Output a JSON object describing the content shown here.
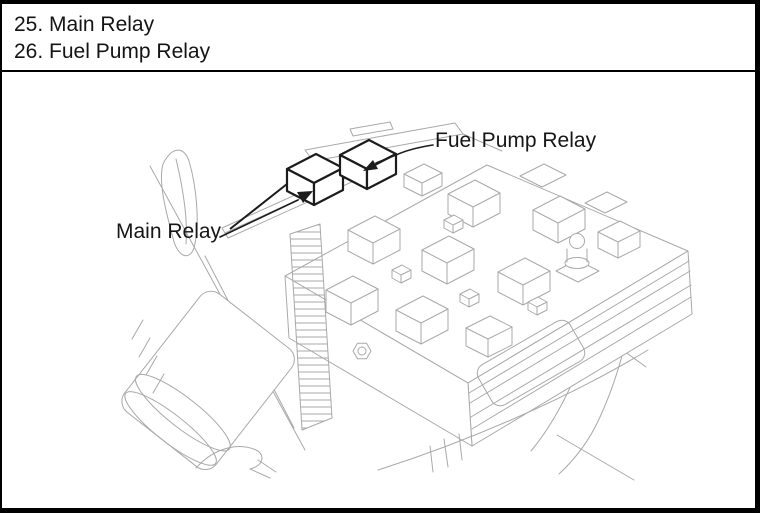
{
  "legend": {
    "items": [
      {
        "number": "25.",
        "label": "Main Relay"
      },
      {
        "number": "26.",
        "label": "Fuel Pump Relay"
      }
    ]
  },
  "diagram": {
    "callouts": [
      {
        "id": "fuel-pump-relay",
        "label": "Fuel Pump Relay"
      },
      {
        "id": "main-relay",
        "label": "Main Relay"
      }
    ]
  },
  "colors": {
    "line": "#a9a9a9",
    "dark": "#1c1c1c",
    "text": "#141414",
    "frame": "#000000"
  }
}
